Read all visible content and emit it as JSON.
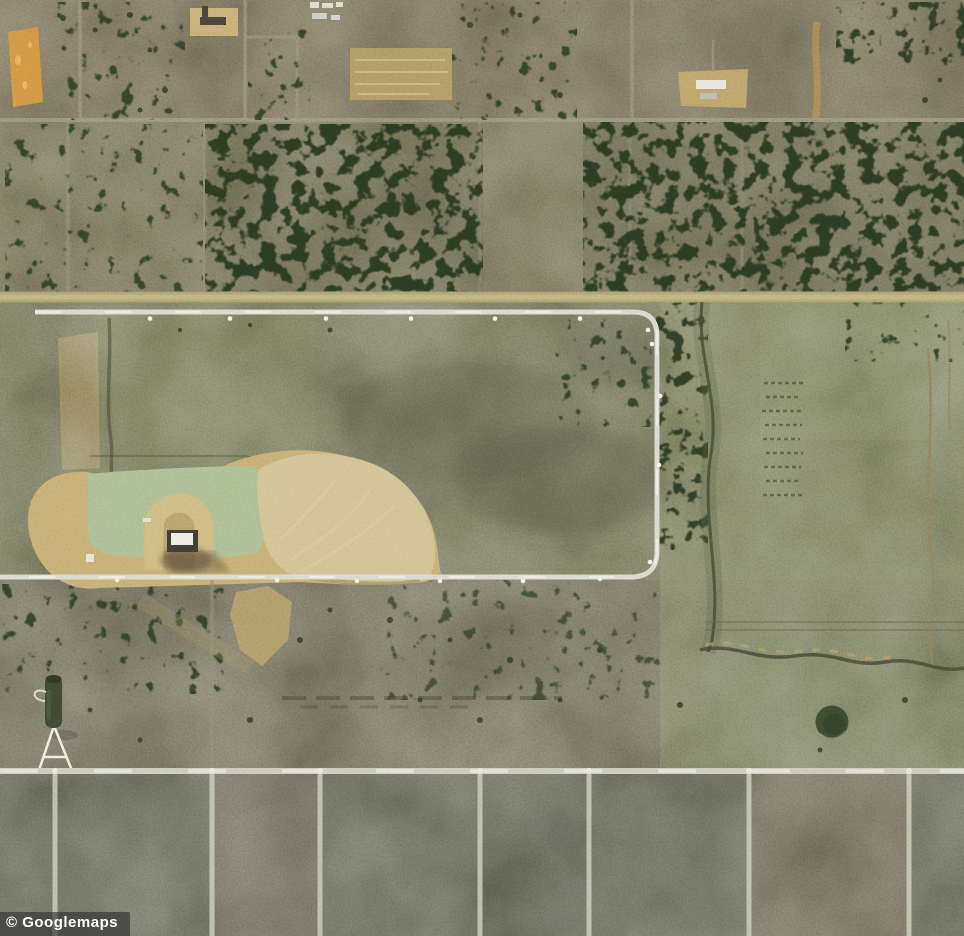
{
  "watermark": {
    "text": "© Googlemaps",
    "bg": "rgba(45,45,45,0.62)",
    "fg": "#ffffff"
  },
  "map": {
    "view": "satellite",
    "colors": {
      "terrain": "#6e6a5a",
      "top_band": "#6f6755",
      "tree_band": "#6e6a56",
      "mid_band": "#6d6e58",
      "south_band": "#6b675a",
      "bottom_band": "#5f6156",
      "tree": "#2c3823",
      "pond": "#a9bb8e",
      "sand": "#c3ab70",
      "sand_bright": "#cdbf8e",
      "orange_field": "#d0913f",
      "road_light": "#d8d7ce",
      "road_tan": "#aaa06b",
      "road_bottom": "#c9c8bb",
      "dark_pond": "#3a472f",
      "right_pasture": "#78805f"
    }
  }
}
